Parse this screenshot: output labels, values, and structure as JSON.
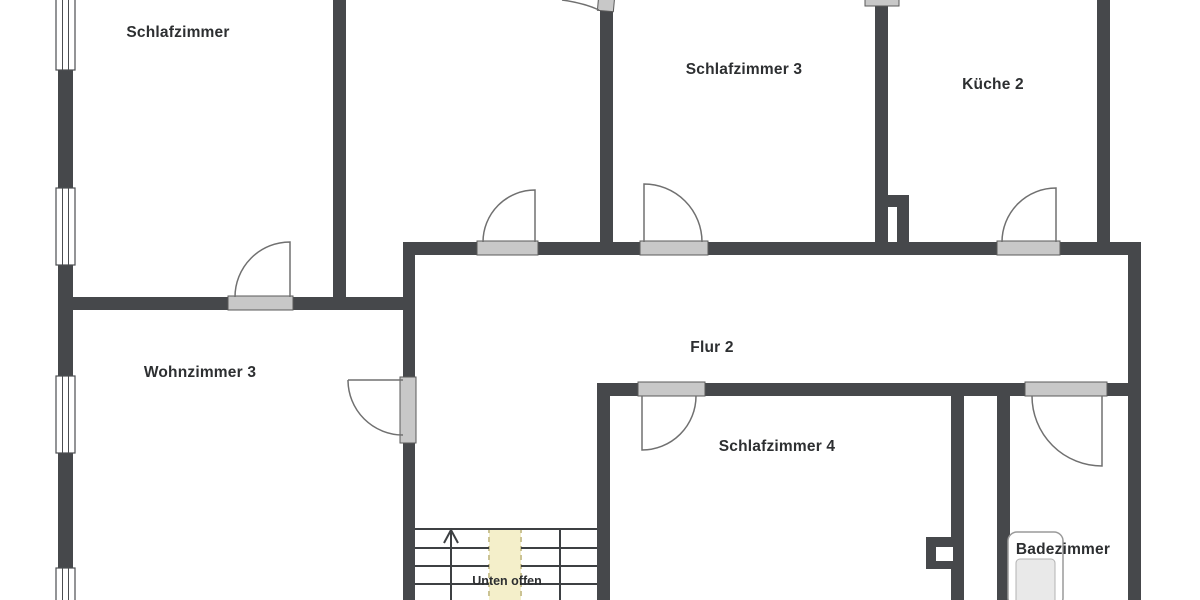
{
  "plan": {
    "rooms": [
      {
        "name": "schlafzimmer",
        "label": "Schlafzimmer"
      },
      {
        "name": "schlafzimmer-2",
        "label": "Schlafzimmer 2"
      },
      {
        "name": "schlafzimmer-3",
        "label": "Schlafzimmer 3"
      },
      {
        "name": "kueche-2",
        "label": "Küche 2"
      },
      {
        "name": "wohnzimmer-3",
        "label": "Wohnzimmer 3"
      },
      {
        "name": "flur-2",
        "label": "Flur 2"
      },
      {
        "name": "schlafzimmer-4",
        "label": "Schlafzimmer 4"
      },
      {
        "name": "badezimmer",
        "label": "Badezimmer"
      }
    ],
    "stairwell": {
      "label": "Unten offen"
    }
  },
  "colors": {
    "wall": "#46484b",
    "threshold_fill": "#c8c8c8",
    "threshold_border": "#5a5a5a",
    "door_swing": "#707070",
    "stair_line": "#3d4043",
    "stair_opening_fill": "#f4efca",
    "stair_opening_edge": "#cbc393",
    "text": "#2d2f31",
    "background": "#ffffff",
    "tub_fill": "#e9e9e9"
  }
}
